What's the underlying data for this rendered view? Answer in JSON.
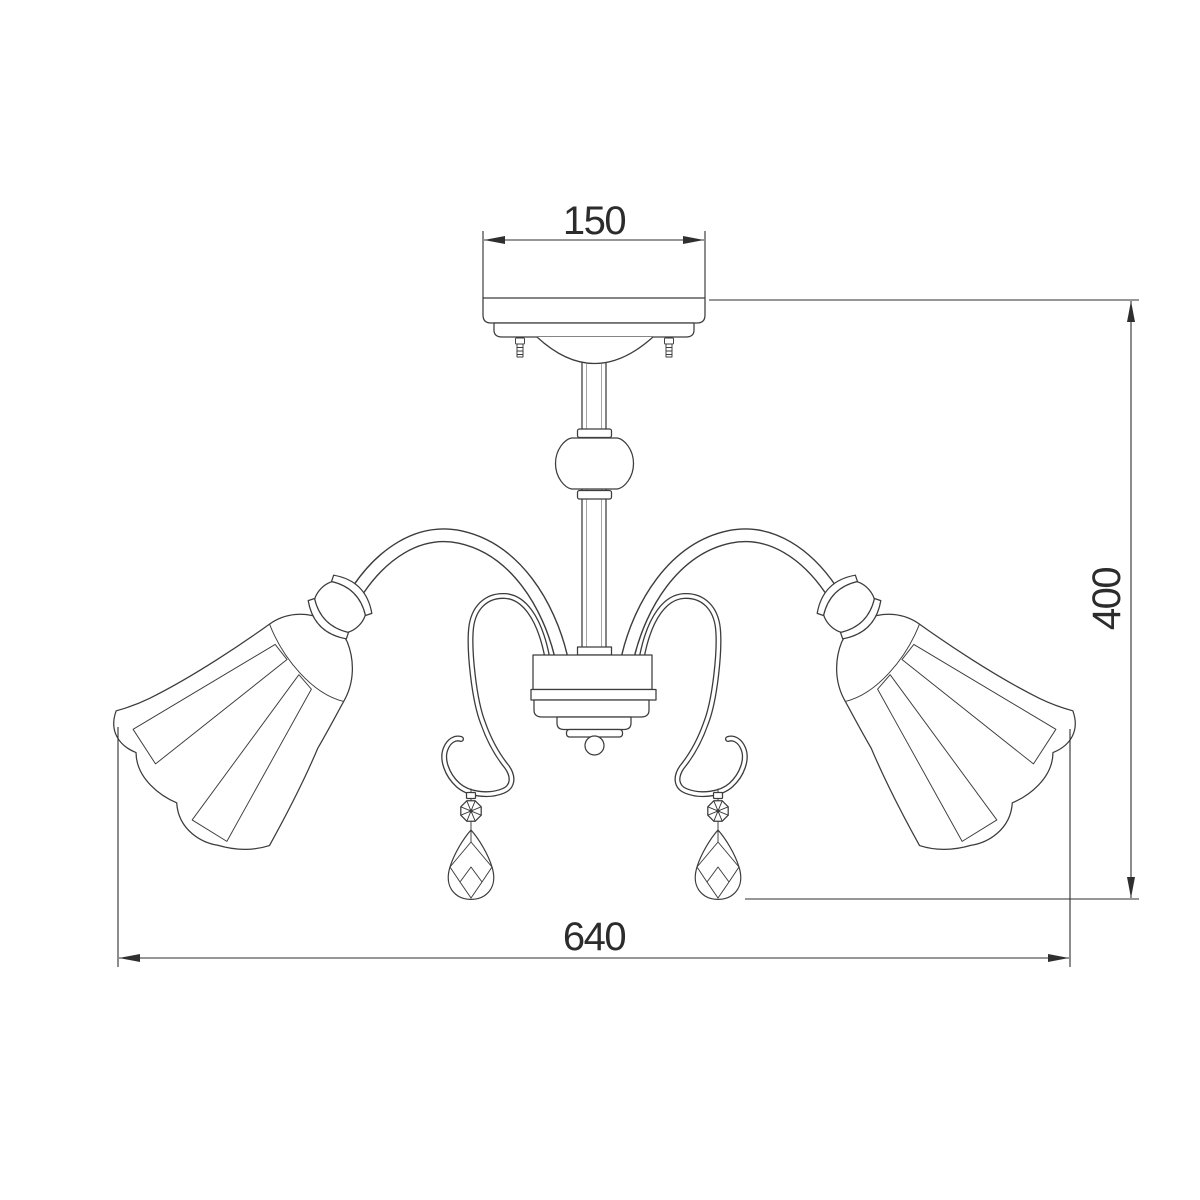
{
  "page": {
    "background": "#ffffff"
  },
  "drawing": {
    "kind": "chandelier-front-view-technical-line-drawing",
    "line_color": "#3c3c3c",
    "dimension_color": "#2f2f2f",
    "parts": [
      "ceiling-canopy",
      "mounting-screw-left",
      "mounting-screw-right",
      "center-stem",
      "crystal-stem-bead",
      "center-hub",
      "hub-finial-ball",
      "curved-arm-left",
      "curved-arm-right",
      "crosshatch-ball-joint-left",
      "crosshatch-ball-joint-right",
      "bell-shade-left",
      "bell-shade-right",
      "s-scroll-hook-left",
      "s-scroll-hook-right",
      "crystal-pendant-left",
      "crystal-pendant-right"
    ]
  },
  "dimensions": {
    "top_width": "150",
    "right_height": "400",
    "bottom_width": "640"
  }
}
